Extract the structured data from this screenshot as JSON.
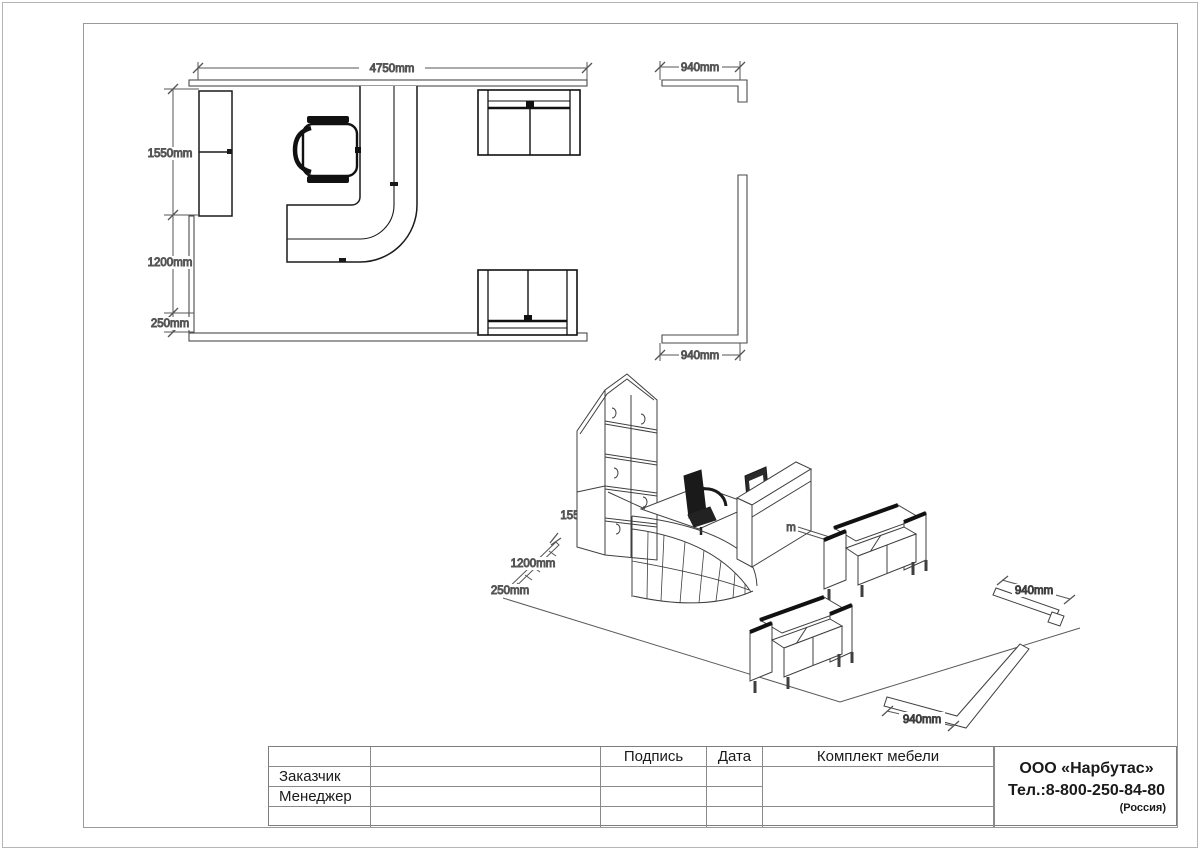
{
  "plan": {
    "dim_top": "4750mm",
    "dim_left_upper": "1550mm",
    "dim_left_middle": "1200mm",
    "dim_left_lower": "250mm",
    "dim_wall_top": "940mm",
    "dim_wall_bottom": "940mm"
  },
  "iso": {
    "dim_shelf_partial": "155",
    "dim_floor_middle": "1200mm",
    "dim_floor_corner": "250mm",
    "dim_leader_partial": "m",
    "dim_wall_upper": "940mm",
    "dim_wall_lower": "940mm"
  },
  "title_block": {
    "signature": "Подпись",
    "date": "Дата",
    "set_title": "Комплект мебели",
    "customer": "Заказчик",
    "manager": "Менеджер"
  },
  "company": {
    "name": "ООО «Нарбутас»",
    "phone": "Тел.:8-800-250-84-80",
    "country": "(Россия)"
  },
  "colors": {
    "background": "#ffffff",
    "frame": "#9a9a9a",
    "furniture_line": "#111111",
    "wall_line": "#4a4a4a",
    "dim_line": "#555555",
    "dim_text": "#3a3a3a"
  }
}
